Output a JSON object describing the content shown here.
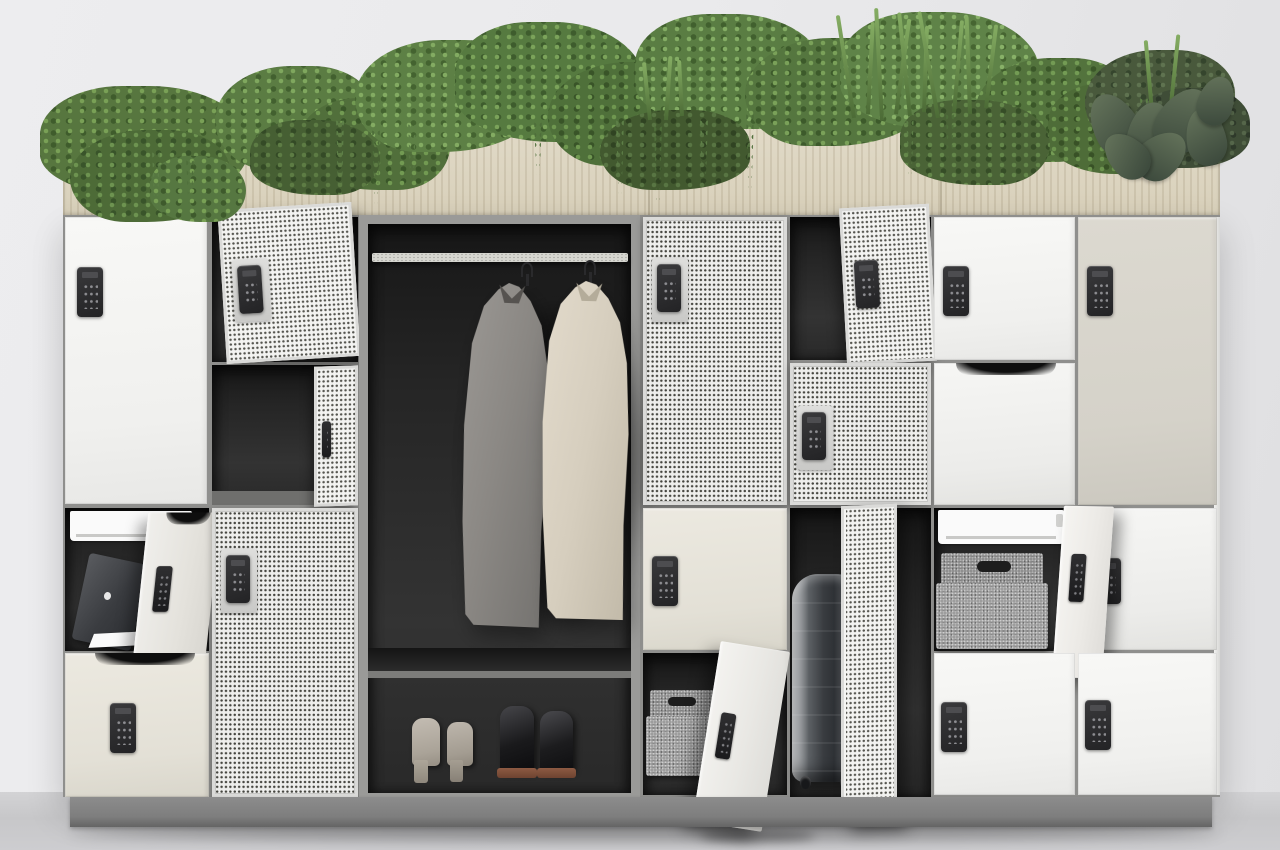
{
  "scene": {
    "description": "Product render of a modern office smart-locker wall: digital keypad locks, perforated mesh doors, an open wardrobe bay with two coats and shoes, open lockers holding a laptop, documents, felt baskets and a suitcase, and a wooden planter of mixed greenery running across the top.",
    "background_color": "#eaeaec",
    "floor_color": "#c7c7c9"
  },
  "planter": {
    "front_material": "light oak wood panel",
    "wood_color": "#dcd4c0",
    "plants": [
      "bushy shrub",
      "trailing vine",
      "fern",
      "palm fronds",
      "ornamental grass",
      "boxwood ball",
      "dark rubber-plant leaves"
    ],
    "green_colors": [
      "#7ba05a",
      "#5f7f45",
      "#45622f",
      "#55694d"
    ]
  },
  "locker_wall": {
    "frame_color": "#8f8f8d",
    "plinth_color": "#828282",
    "door_colors": {
      "white": "#f5f5f3",
      "cream": "#eae7de",
      "greige": "#d9d6cd",
      "mesh": "#eeeeec"
    },
    "lock": {
      "type": "digital keypad",
      "body_color": "#2b2b2d",
      "keys": "3x4 button grid with small display"
    },
    "columns": [
      {
        "id": "c1",
        "units": [
          {
            "door": "tall solid white",
            "state": "closed",
            "lock": "keypad"
          },
          {
            "door": "solid white",
            "state": "open",
            "contents": [
              "paper tray",
              "open laptop",
              "documents"
            ]
          },
          {
            "door": "solid cream with scoop handle",
            "state": "closed",
            "lock": "keypad"
          }
        ]
      },
      {
        "id": "c2",
        "units": [
          {
            "door": "mesh",
            "state": "open",
            "lock": "keypad"
          },
          {
            "door": "mesh",
            "state": "ajar",
            "contents": []
          },
          {
            "door": "tall mesh",
            "state": "closed",
            "lock": "keypad"
          }
        ]
      },
      {
        "id": "c3",
        "type": "open wardrobe bay",
        "contents": [
          "chrome hanging rail",
          "grey overcoat on hanger",
          "cream overcoat on hanger",
          "shoe shelf",
          "beige block-heel boots",
          "black ankle boots"
        ]
      },
      {
        "id": "c4",
        "units": [
          {
            "door": "tall mesh",
            "state": "closed",
            "lock": "keypad"
          },
          {
            "door": "solid cream",
            "state": "closed",
            "lock": "keypad"
          },
          {
            "door": "solid white",
            "state": "open",
            "contents": [
              "grey felt basket"
            ]
          }
        ]
      },
      {
        "id": "c5",
        "units": [
          {
            "door": "mesh",
            "state": "open",
            "lock": "keypad"
          },
          {
            "door": "mesh",
            "state": "closed",
            "lock": "keypad"
          },
          {
            "door": "tall mesh",
            "state": "open",
            "contents": [
              "silver suitcase"
            ]
          }
        ]
      },
      {
        "id": "c6",
        "units": [
          {
            "door": "solid white",
            "state": "closed",
            "lock": "keypad"
          },
          {
            "door": "solid white with scoop handle",
            "state": "closed"
          },
          {
            "door": "solid white",
            "state": "open",
            "contents": [
              "paper tray",
              "grey felt basket"
            ]
          },
          {
            "door": "solid white",
            "state": "closed",
            "lock": "keypad"
          }
        ]
      },
      {
        "id": "c7",
        "units": [
          {
            "door": "tall solid greige",
            "state": "closed",
            "lock": "keypad"
          },
          {
            "door": "solid white",
            "state": "closed",
            "lock": "keypad"
          },
          {
            "door": "solid white",
            "state": "closed",
            "lock": "keypad"
          }
        ]
      }
    ]
  },
  "objects": {
    "laptop": {
      "label": "open laptop leaning inside locker",
      "color": "#3f4144"
    },
    "suitcase": {
      "label": "silver hard-shell suitcase",
      "color": "#b9bcbe"
    },
    "felt_basket_small": {
      "label": "grey felt storage basket",
      "color": "#9c9c9c"
    },
    "felt_basket_large": {
      "label": "grey felt storage basket with handle",
      "color": "#9c9c9c"
    },
    "coat_grey": {
      "label": "grey wool coat on hanger",
      "color": "#8f8c88"
    },
    "coat_cream": {
      "label": "cream wool coat on hanger",
      "color": "#d8d0c2"
    },
    "shoes_beige": {
      "label": "beige block-heel boots",
      "color": "#b3aca2"
    },
    "shoes_black": {
      "label": "black ankle boots",
      "color": "#1e1e1e"
    },
    "documents": {
      "label": "white papers"
    }
  }
}
